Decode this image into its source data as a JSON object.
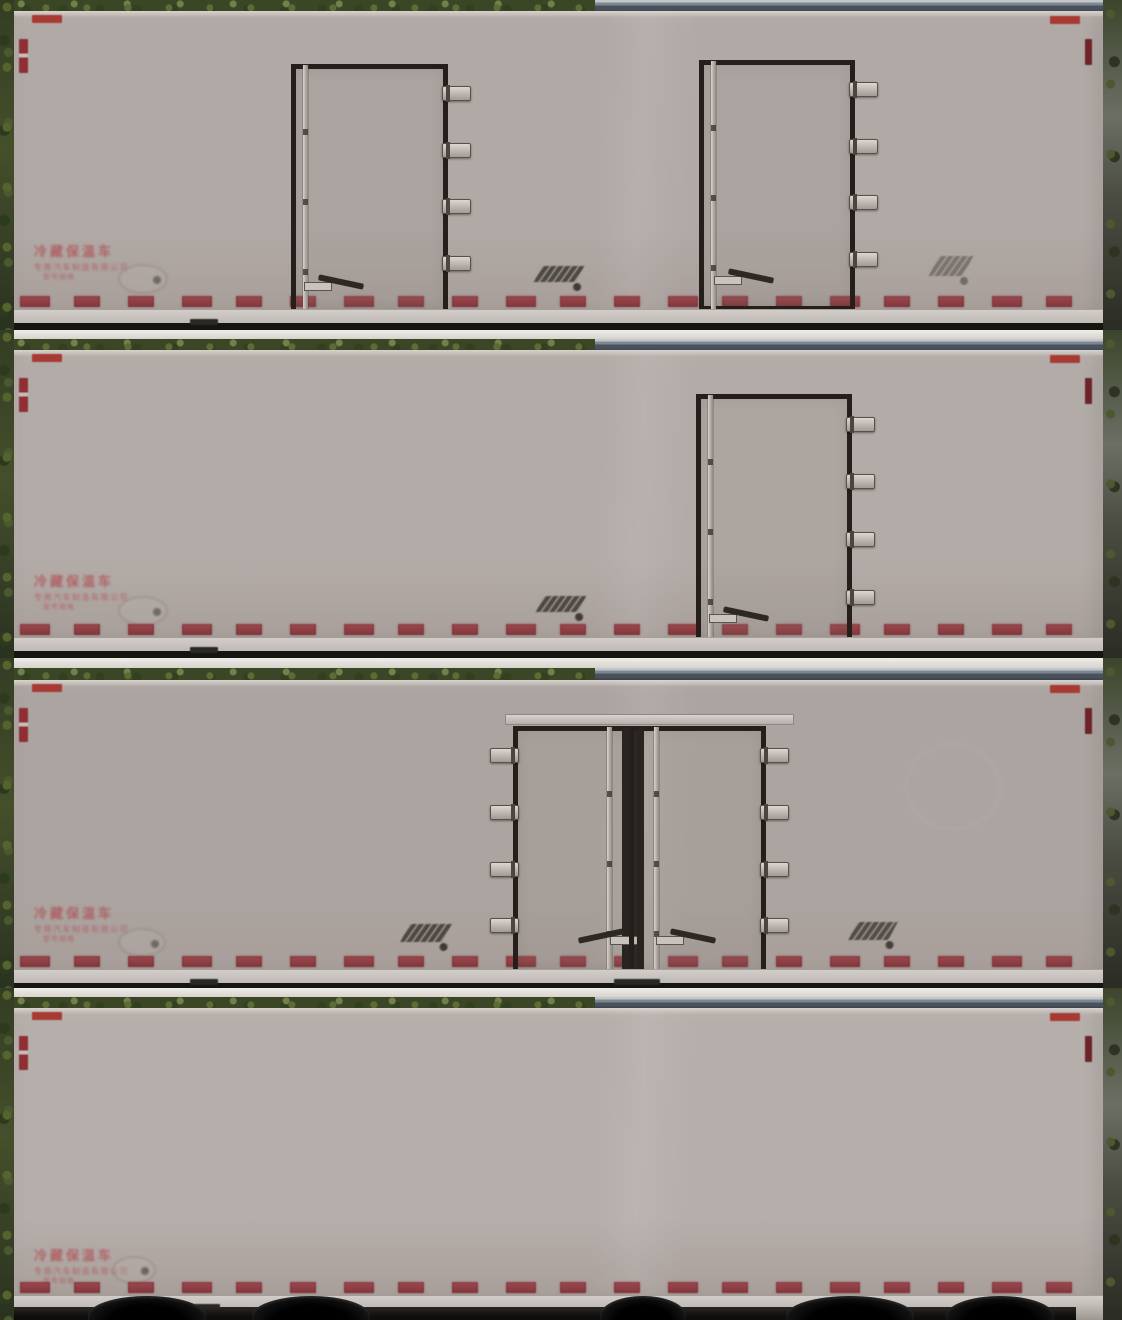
{
  "markings": {
    "line1": "冷藏保温车",
    "line2": "专用汽车制造有限公司",
    "line3": "型号规格"
  },
  "colors": {
    "panel": "#b1a9a5",
    "door_frame": "#241f1b",
    "hinge": "#c6c0ba",
    "reflector_red": "#a83a34",
    "reflector_dark_red": "#6d2327",
    "tape_red": "#8e3136",
    "marking_text_red": "#b05257",
    "rail_gray": "#cbc5c0",
    "foliage_green": "#3a4626",
    "road_stripe_gray": "#49525c",
    "underbody_black": "#131211"
  },
  "strips": [
    {
      "name": "side-with-two-doors",
      "top": 0,
      "height": 330,
      "gap": 0,
      "band_h": 13,
      "box_top": 11,
      "box_h": 311,
      "rail": 13,
      "panel": "#b1a9a5",
      "text_y": 246,
      "doors": [
        {
          "x": 291,
          "y": 64,
          "w": 147,
          "h": 241,
          "hinge": "right",
          "rods": [
            {
              "side": "left",
              "off": 7,
              "w": 5,
              "tone": "light"
            }
          ],
          "handle": {
            "x": 8,
            "y": 206,
            "dir": "right"
          }
        },
        {
          "x": 699,
          "y": 60,
          "w": 146,
          "h": 241,
          "hinge": "right",
          "rods": [
            {
              "side": "left",
              "off": 7,
              "w": 5,
              "tone": "light"
            }
          ],
          "handle": {
            "x": 10,
            "y": 204,
            "dir": "right"
          }
        }
      ],
      "emblems": [
        {
          "type": "oval",
          "x": 118,
          "y": 264,
          "w": 46,
          "h": 26,
          "dot": 1,
          "op": 0.5
        },
        {
          "type": "stripe",
          "x": 538,
          "y": 266,
          "w": 42,
          "h": 16,
          "dot": 1,
          "op": 0.85
        },
        {
          "type": "stripe",
          "x": 934,
          "y": 256,
          "w": 34,
          "h": 20,
          "dot": 1,
          "op": 0.45
        }
      ],
      "flaps": [
        {
          "x": 176,
          "w": 28
        }
      ]
    },
    {
      "name": "side-with-one-door",
      "top": 330,
      "height": 328,
      "gap": 9,
      "band_h": 13,
      "box_top": 20,
      "box_h": 300,
      "rail": 13,
      "panel": "#b3aba7",
      "text_y": 246,
      "doors": [
        {
          "x": 696,
          "y": 64,
          "w": 146,
          "h": 246,
          "hinge": "right",
          "rods": [
            {
              "side": "left",
              "off": 7,
              "w": 5,
              "tone": "light"
            }
          ],
          "handle": {
            "x": 8,
            "y": 208,
            "dir": "right"
          }
        }
      ],
      "emblems": [
        {
          "type": "oval",
          "x": 118,
          "y": 266,
          "w": 46,
          "h": 26,
          "dot": 1,
          "op": 0.5
        },
        {
          "type": "stripe",
          "x": 540,
          "y": 266,
          "w": 42,
          "h": 16,
          "dot": 1,
          "op": 0.85
        }
      ],
      "flaps": [
        {
          "x": 176,
          "w": 28
        }
      ]
    },
    {
      "name": "side-with-double-doors",
      "top": 658,
      "height": 330,
      "gap": 10,
      "band_h": 13,
      "box_top": 22,
      "box_h": 302,
      "rail": 13,
      "panel": "#aca4a0",
      "text_y": 250,
      "sill": {
        "x": 505,
        "y": 56,
        "w": 287,
        "h": 9
      },
      "doors": [
        {
          "x": 513,
          "y": 68,
          "w": 114,
          "h": 242,
          "hinge": "left",
          "rods": [
            {
              "side": "right",
              "off": 3,
              "w": 7,
              "tone": "dark"
            },
            {
              "side": "right",
              "off": 20,
              "w": 5,
              "tone": "light"
            }
          ],
          "handle": {
            "x": 58,
            "y": 198,
            "dir": "left"
          }
        },
        {
          "x": 629,
          "y": 68,
          "w": 127,
          "h": 242,
          "hinge": "right",
          "rods": [
            {
              "side": "left",
              "off": 3,
              "w": 7,
              "tone": "dark"
            },
            {
              "side": "left",
              "off": 20,
              "w": 5,
              "tone": "light"
            }
          ],
          "handle": {
            "x": 22,
            "y": 198,
            "dir": "right"
          }
        }
      ],
      "emblems": [
        {
          "type": "oval",
          "x": 118,
          "y": 270,
          "w": 44,
          "h": 25,
          "dot": 1,
          "op": 0.5
        },
        {
          "type": "stripe",
          "x": 405,
          "y": 266,
          "w": 42,
          "h": 18,
          "dot": 1,
          "op": 0.85
        },
        {
          "type": "stripe",
          "x": 853,
          "y": 264,
          "w": 40,
          "h": 18,
          "dot": 1,
          "op": 0.8
        },
        {
          "type": "circle",
          "x": 905,
          "y": 86,
          "w": 92,
          "h": 82,
          "op": 0.35
        }
      ],
      "flaps": [
        {
          "x": 176,
          "w": 28
        },
        {
          "x": 600,
          "w": 46
        }
      ]
    },
    {
      "name": "plain-side",
      "top": 988,
      "height": 332,
      "gap": 9,
      "band_h": 12,
      "box_top": 20,
      "box_h": 299,
      "rail": 12,
      "panel": "#b6aeaa",
      "text_y": 262,
      "doors": [],
      "emblems": [
        {
          "type": "oval",
          "x": 112,
          "y": 268,
          "w": 40,
          "h": 24,
          "dot": 1,
          "op": 0.55
        }
      ],
      "flaps": [
        {
          "x": 180,
          "w": 26
        }
      ],
      "wheels": [
        {
          "x": 88,
          "w": 118
        },
        {
          "x": 252,
          "w": 118
        },
        {
          "x": 600,
          "w": 86
        },
        {
          "x": 786,
          "w": 128
        },
        {
          "x": 946,
          "w": 108
        }
      ],
      "tailbox": {
        "x": 1076,
        "w": 44
      }
    }
  ]
}
